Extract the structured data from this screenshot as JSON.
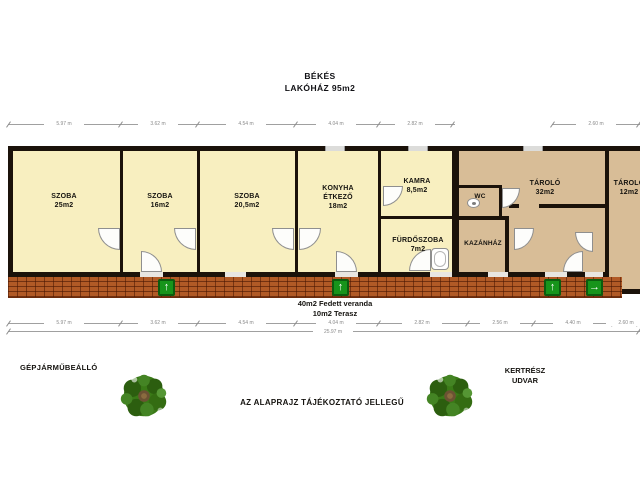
{
  "title": {
    "line1": "BÉKÉS",
    "line2": "LAKÓHÁZ  95m2"
  },
  "rooms": {
    "szoba1": {
      "name": "SZOBA",
      "area": "25m2"
    },
    "szoba2": {
      "name": "SZOBA",
      "area": "16m2"
    },
    "szoba3": {
      "name": "SZOBA",
      "area": "20,5m2"
    },
    "konyha": {
      "name": "KONYHA",
      "name2": "ÉTKEZŐ",
      "area": "18m2"
    },
    "kamra": {
      "name": "KAMRA",
      "area": "8,5m2"
    },
    "wc": {
      "name": "WC"
    },
    "furdo": {
      "name": "FÜRDŐSZOBA",
      "area": "7m2"
    },
    "kazanhaz": {
      "name": "KAZÁNHÁZ"
    },
    "tarolo1": {
      "name": "TÁROLÓ",
      "area": "32m2"
    },
    "tarolo2": {
      "name": "TÁROLÓ",
      "area": "12m2"
    }
  },
  "veranda": {
    "line1": "40m2  Fedett veranda",
    "line2": "10m2  Terasz"
  },
  "site": {
    "carport": "GÉPJÁRMŰBEÁLLÓ",
    "garden_line1": "KERTRÉSZ",
    "garden_line2": "UDVAR",
    "disclaimer": "AZ ALAPRAJZ TÁJÉKOZTATÓ JELLEGŰ"
  },
  "dimensions": {
    "top": [
      "5.97 m",
      "3.62 m",
      "4.54 m",
      "4.04 m",
      "2.82 m",
      "2.60 m"
    ],
    "bottom": [
      "5.97 m",
      "3.62 m",
      "4.54 m",
      "4.04 m",
      "2.82 m",
      "2.56 m",
      "4.40 m",
      "2.60 m"
    ],
    "total": "25.97 m"
  },
  "icons": {
    "arrow_up": "↑",
    "arrow_right": "→"
  },
  "colors": {
    "room_fill": "#f8efc0",
    "storage_fill": "#d8bd97",
    "wall": "#1b120a",
    "brick": "#b15a26",
    "arrow_green": "#17941b"
  }
}
